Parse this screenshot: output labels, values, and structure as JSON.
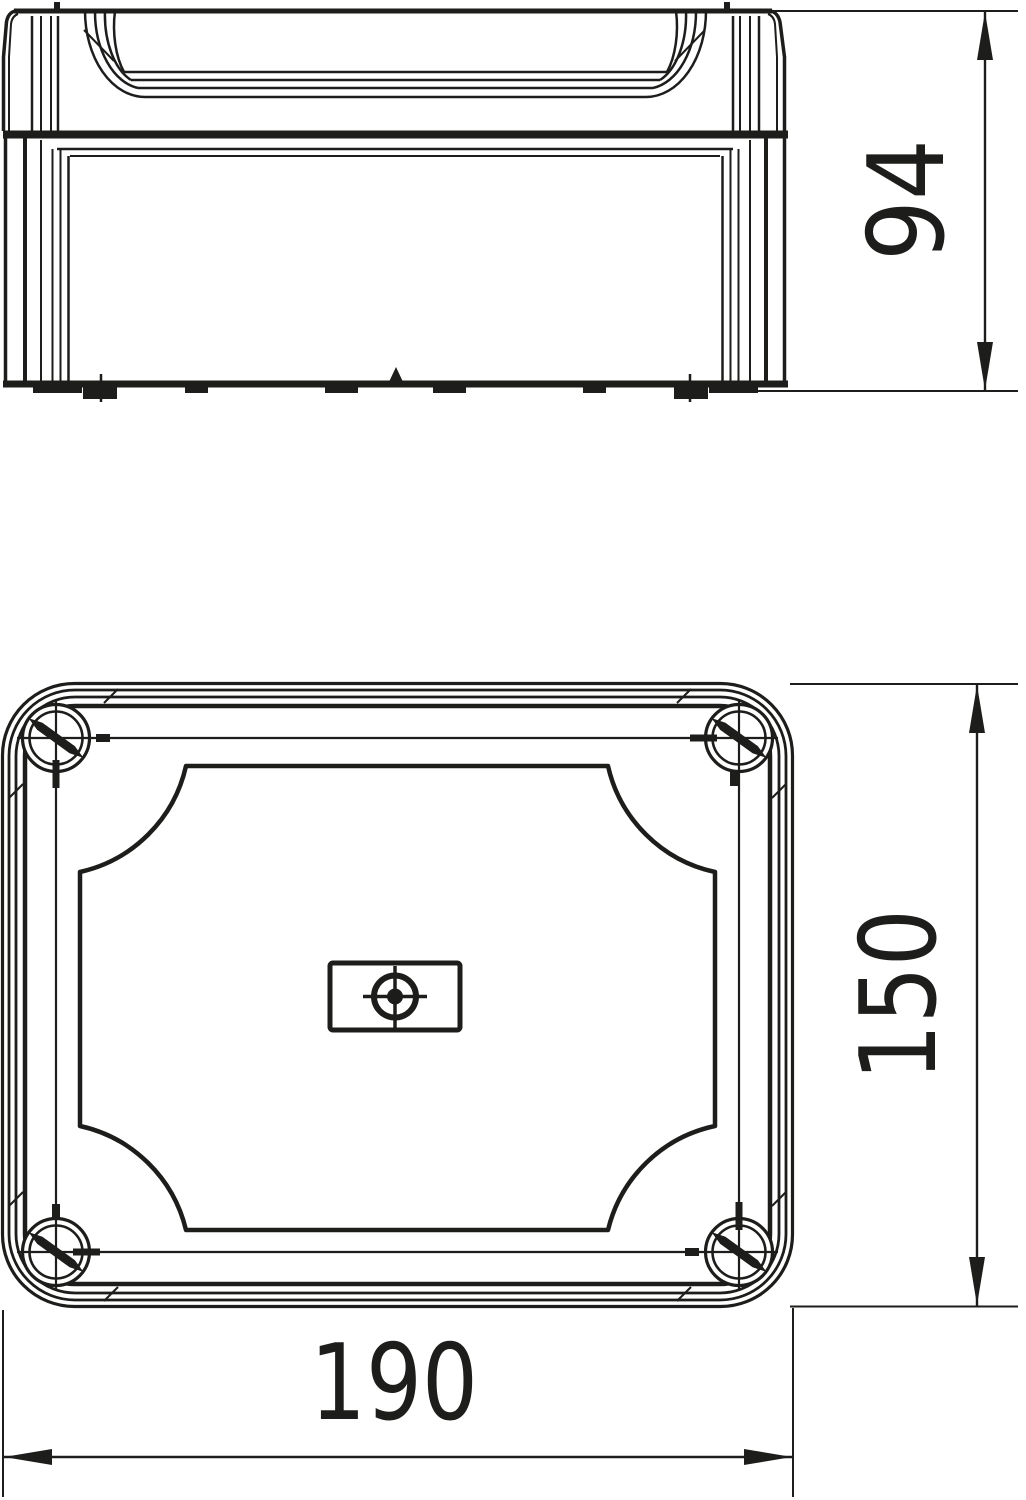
{
  "drawing": {
    "kind": "technical dimensional drawing",
    "subject": "junction box, two orthographic views",
    "line_color": "#1d1d1b",
    "background_color": "#ffffff",
    "views": [
      {
        "id": "front-view",
        "label": "front elevation with lid"
      },
      {
        "id": "top-view",
        "label": "plan view of lid with corner screws"
      }
    ],
    "dimensions": {
      "height": {
        "value": "94",
        "orientation": "vertical",
        "view": "front-view"
      },
      "depth": {
        "value": "150",
        "orientation": "vertical",
        "view": "top-view"
      },
      "width": {
        "value": "190",
        "orientation": "horizontal",
        "view": "top-view"
      }
    }
  }
}
